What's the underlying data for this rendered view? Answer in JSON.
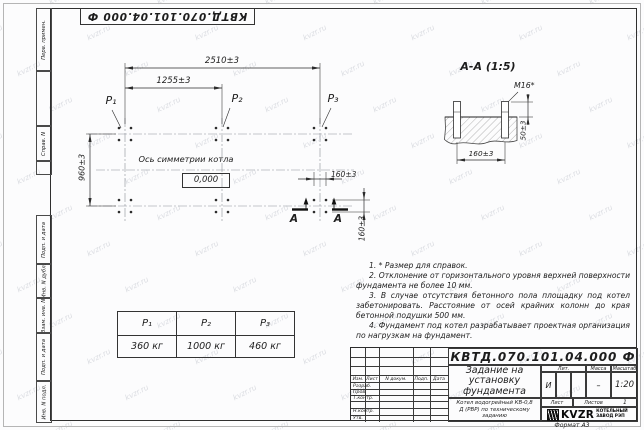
{
  "watermark": {
    "text": "kvzr.ru"
  },
  "stamp_vertical": {
    "doc_number_top": "КВТД.070.101.04.000 Ф"
  },
  "side_strip": {
    "items": [
      "Перв. примен.",
      "Справ. N",
      "Подп. и дата",
      "Инв. N дубл.",
      "Взам. инв. N",
      "Подп. и дата",
      "Инв. N подл."
    ]
  },
  "plan": {
    "dims": {
      "overall": "2510±3",
      "half": "1255±3",
      "depth": "960±3",
      "bolt_h": "160±3",
      "bolt_v": "160±3"
    },
    "points": [
      "P₁",
      "P₂",
      "P₃"
    ],
    "axis_label": "Ось симметрии котла",
    "level_mark": "0,000",
    "section_letter_left": "А",
    "section_letter_right": "А"
  },
  "section": {
    "title": "А-А (1:5)",
    "bolt_label": "M16*",
    "dim_height": "50±3",
    "dim_spacing": "160±3"
  },
  "notes": [
    "1. * Размер для справок.",
    "2. Отклонение от горизонтального уровня верхней поверхности фундамента не более 10 мм.",
    "3. В случае отсутствия бетонного пола площадку под котел забетонировать. Расстояние от осей крайних колонн до края бетонной подушки 500 мм.",
    "4. Фундамент под котел разрабатывает проектная организация по нагрузкам на фундамент."
  ],
  "load_table": {
    "headers": [
      "P₁",
      "P₂",
      "P₃"
    ],
    "values": [
      "360 кг",
      "1000 кг",
      "460 кг"
    ]
  },
  "title_block": {
    "doc_number": "КВТД.070.101.04.000 Ф",
    "title": "Задание на установку фундамента",
    "product": "Котел водогрейный КВ-0,8 Д (РВР) по техническому заданию",
    "lit_label": "Лит.",
    "lit_value": "И",
    "mass_label": "Масса",
    "mass_value": "–",
    "scale_label": "Масштаб",
    "scale_value": "1:20",
    "sheet_label": "Лист",
    "sheets_label": "Листов",
    "sheets_value": "1",
    "header_cols": [
      "Изм.",
      "Лист",
      "N докум.",
      "Подп.",
      "Дата"
    ],
    "roles": [
      "Разраб.",
      "Пров.",
      "Т.контр.",
      "Н.контр.",
      "Утв."
    ],
    "logo_text": "KVZR",
    "company_line1": "КОТЕЛЬНЫЙ",
    "company_line2": "ЗАВОД РЭП",
    "format_label": "Формат А3"
  }
}
